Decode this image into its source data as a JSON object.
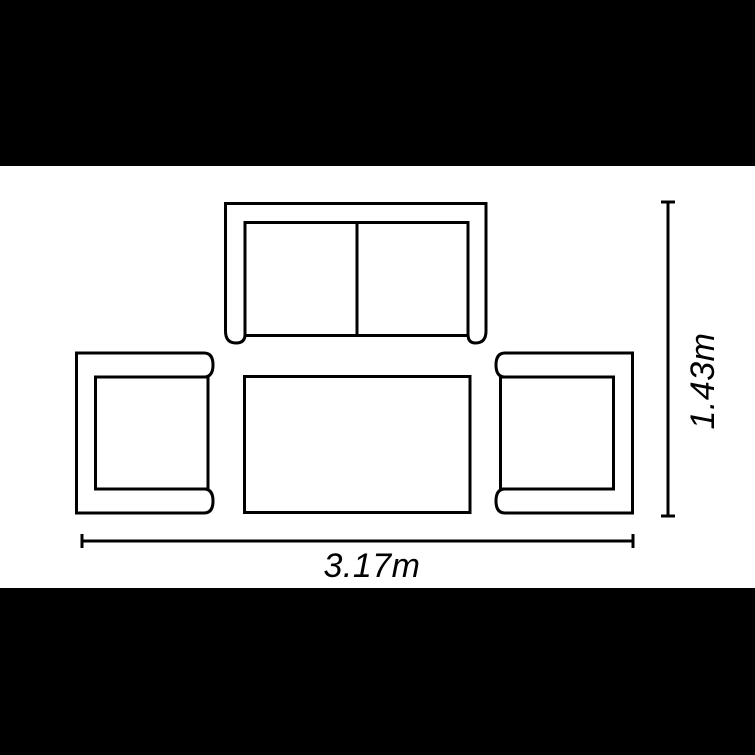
{
  "colors": {
    "letterbox": "#000000",
    "canvas": "#ffffff",
    "line": "#000000"
  },
  "dimensions": {
    "width_label": "3.17m",
    "height_label": "1.43m"
  },
  "furniture": {
    "sofa": "two-seater-sofa-top-view",
    "left_chair": "armchair-top-view-left",
    "right_chair": "armchair-top-view-right",
    "table": "coffee-table-top-view"
  }
}
